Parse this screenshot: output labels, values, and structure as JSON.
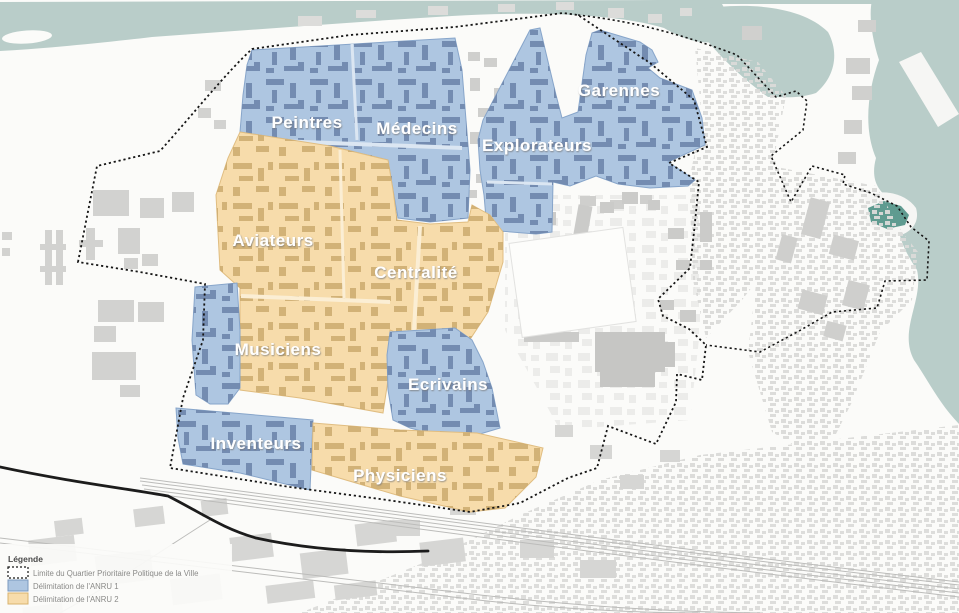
{
  "map": {
    "labels": {
      "peintres": "Peintres",
      "medecins": "Médecins",
      "garennes": "Garennes",
      "explorateurs": "Explorateurs",
      "aviateurs": "Aviateurs",
      "centralite": "Centralité",
      "musiciens": "Musiciens",
      "ecrivains": "Ecrivains",
      "inventeurs": "Inventeurs",
      "physiciens": "Physiciens"
    },
    "legend": {
      "title": "Légende",
      "items": [
        {
          "swatch": "dotted-boundary",
          "label": "Limite du Quartier Prioritaire Politique de la Ville"
        },
        {
          "swatch": "anru1-blue",
          "label": "Délimitation de l'ANRU 1"
        },
        {
          "swatch": "anru2-orange",
          "label": "Délimitation de l'ANRU 2"
        }
      ]
    },
    "colors": {
      "anru1_fill": "#aec6e1",
      "anru1_building": "#6e86ac",
      "anru2_fill": "#f7dcab",
      "anru2_building": "#c9a76a",
      "water": "#b9cdc9",
      "water_dark": "#5f9b90",
      "building_gray": "#d4d4d2",
      "boundary": "#161616"
    }
  }
}
